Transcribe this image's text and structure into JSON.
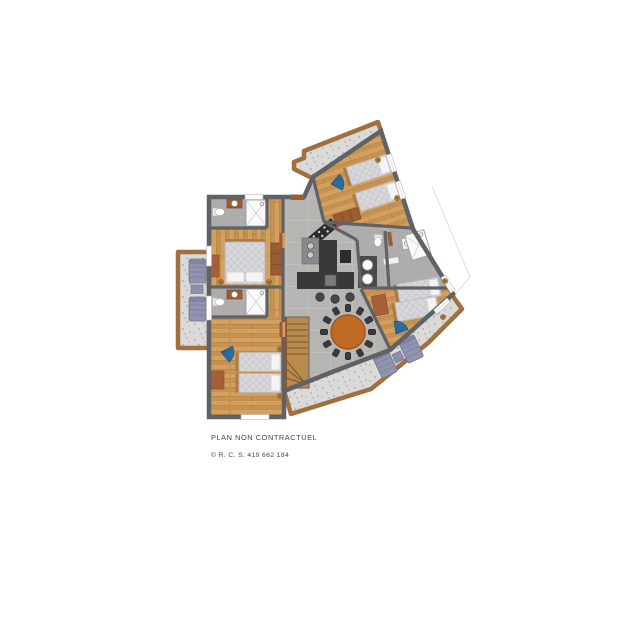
{
  "footer": {
    "disclaimer": "PLAN NON CONTRACTUEL",
    "registration": "© R. C. S. 419 662 184"
  },
  "palette": {
    "wall": "#5f6266",
    "wood_floor": "#d4a05f",
    "wood_floor_dark": "#c6924f",
    "tile_floor": "#b6b5b2",
    "bathroom_floor": "#adacaa",
    "terrace_floor": "#dadad8",
    "terrace_border": "#a26f3e",
    "dining_table": "#bf6a24",
    "armchair_blue": "#2e6da3",
    "lounger_purple": "#9193af",
    "kitchen_island": "#39393b",
    "bed_quilt": "#d8d8db",
    "accent_rust": "#a65f38",
    "wardrobe_brown": "#9a5c33",
    "lamp_gold": "#c08737",
    "text": "#44484d"
  }
}
